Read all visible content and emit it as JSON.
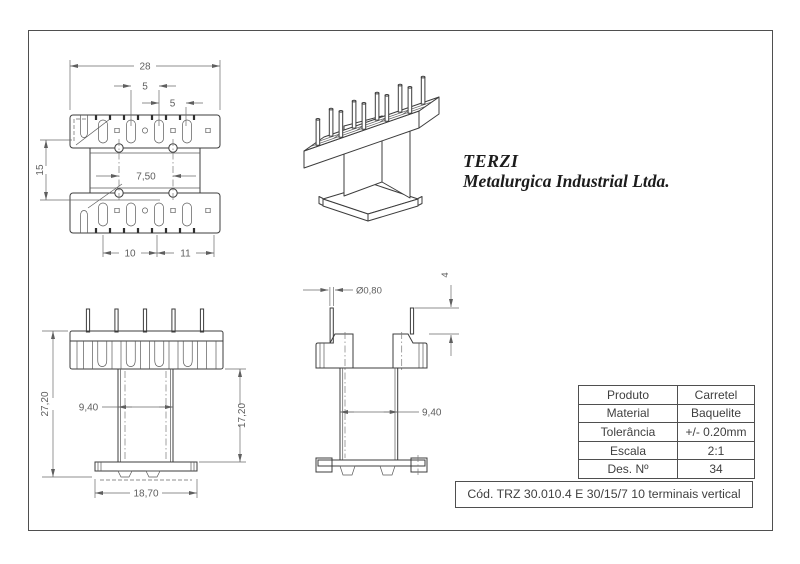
{
  "company": {
    "name": "TERZI",
    "subtitle": "Metalurgica Industrial Ltda."
  },
  "colors": {
    "outline": "#3c3c3c",
    "dimension": "#5f5f5f",
    "frame": "#4f4f4f"
  },
  "views": {
    "top": {
      "dims": {
        "overall_width": "28",
        "pin_pitch_left": "5",
        "pin_pitch_right": "5",
        "flange_window": "15",
        "hole_spacing": "7,50",
        "terminal_row_left": "10",
        "terminal_row_right": "11"
      }
    },
    "front": {
      "dims": {
        "overall_height": "27,20",
        "core_width": "9,40",
        "body_height": "17,20",
        "base_width": "18,70"
      }
    },
    "side": {
      "dims": {
        "pin_diameter": "Ø0,80",
        "pin_protrusion": "4",
        "core_depth": "9,40"
      }
    }
  },
  "title_block": {
    "rows": [
      {
        "label": "Produto",
        "value": "Carretel"
      },
      {
        "label": "Material",
        "value": "Baquelite"
      },
      {
        "label": "Tolerância",
        "value": "+/- 0.20mm"
      },
      {
        "label": "Escala",
        "value": "2:1"
      },
      {
        "label": "Des. Nº",
        "value": "34"
      }
    ],
    "code": "Cód. TRZ 30.010.4 E 30/15/7 10 terminais vertical"
  }
}
